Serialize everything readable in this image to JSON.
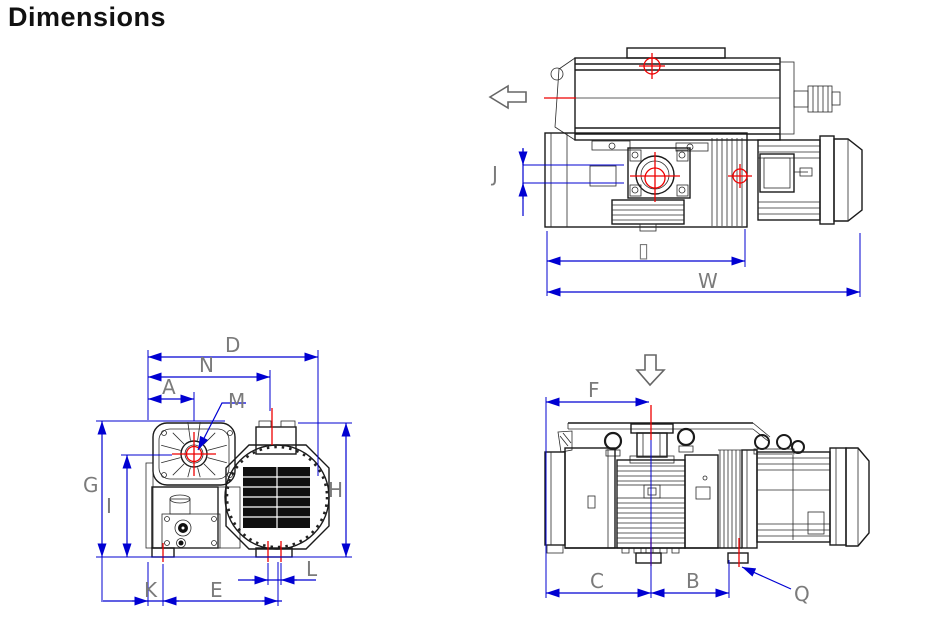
{
  "title": "Dimensions",
  "drawing": {
    "top_view": {
      "labels": {
        "j": "J",
        "box": "▯",
        "w": "W"
      }
    },
    "front_view": {
      "labels": {
        "d": "D",
        "n": "N",
        "a": "A",
        "m": "M",
        "g": "G",
        "i": "I",
        "h": "H",
        "k": "K",
        "e": "E",
        "l": "L"
      }
    },
    "side_view": {
      "labels": {
        "f": "F",
        "c": "C",
        "b": "B",
        "q": "Q"
      }
    },
    "colors": {
      "dimension_blue": "#0000d2",
      "centerline_red": "#ee0000",
      "label_gray": "#7b7b7b",
      "line_black": "#1a1a1a"
    }
  }
}
